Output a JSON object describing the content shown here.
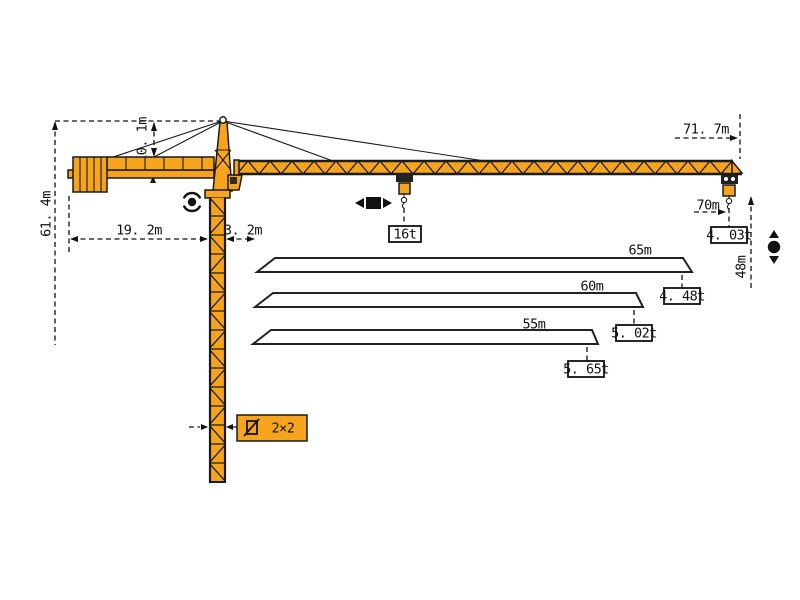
{
  "colors": {
    "crane_orange": "#F7A41D",
    "line": "#1A1A1A",
    "background": "#FFFFFF"
  },
  "dimensions": {
    "total_height": "61. 4m",
    "head_height": "10. 1m",
    "counterjib_length": "19. 2m",
    "rear_offset": "3. 2m",
    "jib_span": "71. 7m",
    "hook_range": "48m"
  },
  "loads": {
    "max_load": "16t"
  },
  "configurations": [
    {
      "jib": "70m",
      "tip_load": "4. 03t"
    },
    {
      "jib": "65m",
      "tip_load": "4. 48t"
    },
    {
      "jib": "60m",
      "tip_load": "5. 02t"
    },
    {
      "jib": "55m",
      "tip_load": "5. 65t"
    }
  ],
  "mast": {
    "section": "2×2"
  },
  "icons": {
    "slewing": "rotation-icon",
    "trolley_travel": "left-right-arrows-icon",
    "hoisting": "up-down-arrows-icon",
    "mast_section": "section-symbol-icon"
  }
}
